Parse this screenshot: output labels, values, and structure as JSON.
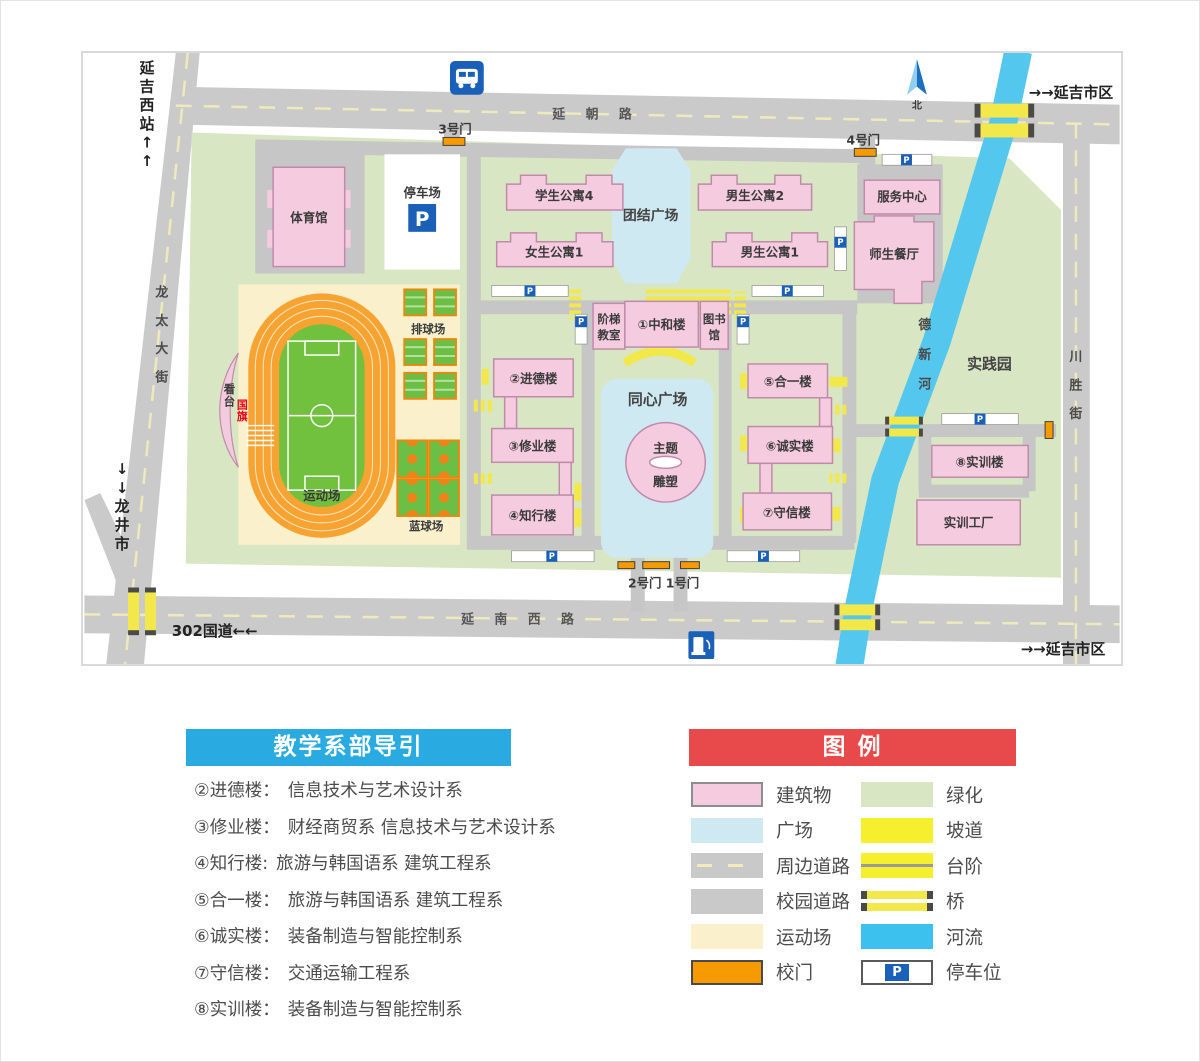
{
  "map": {
    "p": "P",
    "labels": {
      "station": "延吉西站↑↑",
      "city_top": "→→延吉市区",
      "city_bottom": "→→延吉市区",
      "longjing": "↓↓龙井市",
      "national_road": "302国道←←",
      "north": "北",
      "road_yanchao": "延 朝 路",
      "road_yannanxi": "延 南 西 路",
      "road_longtai": "龙太大街",
      "road_chuansheng": "川胜街",
      "river_dexin": "德新河",
      "gate3": "3号门",
      "gate4": "4号门",
      "gate21": "2号门 1号门",
      "parking_lot": "停车场"
    },
    "buildings": {
      "tiyuguan": "体育馆",
      "xuesheng4": "学生公寓4",
      "nansheng2": "男生公寓2",
      "nvsheng1": "女生公寓1",
      "nansheng1": "男生公寓1",
      "fuwu": "服务中心",
      "shisheng": "师生餐厅",
      "jieti1": "阶梯",
      "jieti2": "教室",
      "zhonghe": "①中和楼",
      "tushu1": "图书",
      "tushu2": "馆",
      "jinde": "②进德楼",
      "xiuye": "③修业楼",
      "zhixing": "④知行楼",
      "heyi": "⑤合一楼",
      "chengshi": "⑥诚实楼",
      "shouxin": "⑦守信楼",
      "shixunlou": "⑧实训楼",
      "shixun_gongchang": "实训工厂"
    },
    "areas": {
      "tuanjie": "团结广场",
      "tongxin": "同心广场",
      "shijianyuan": "实践园",
      "paiqiuchang": "排球场",
      "lanqiuchang": "蓝球场",
      "yundongchang": "运动场",
      "kantai": "看台",
      "guoqi": "国旗",
      "zhuti": "主题",
      "diaosu": "雕塑"
    }
  },
  "guide": {
    "title": "教学系部导引",
    "items": [
      {
        "name": "②进德楼：",
        "dept": "信息技术与艺术设计系"
      },
      {
        "name": "③修业楼：",
        "dept": "财经商贸系  信息技术与艺术设计系"
      },
      {
        "name": "④知行楼:",
        "dept": "旅游与韩国语系  建筑工程系"
      },
      {
        "name": "⑤合一楼：",
        "dept": "旅游与韩国语系  建筑工程系"
      },
      {
        "name": "⑥诚实楼：",
        "dept": "装备制造与智能控制系"
      },
      {
        "name": "⑦守信楼：",
        "dept": "交通运输工程系"
      },
      {
        "name": "⑧实训楼：",
        "dept": "装备制造与智能控制系"
      }
    ]
  },
  "legend": {
    "title": "图  例",
    "col1": [
      {
        "label": "建筑物"
      },
      {
        "label": "广场"
      },
      {
        "label": "周边道路"
      },
      {
        "label": "校园道路"
      },
      {
        "label": "运动场"
      },
      {
        "label": "校门"
      }
    ],
    "col2": [
      {
        "label": "绿化"
      },
      {
        "label": "坡道"
      },
      {
        "label": "台阶"
      },
      {
        "label": "桥"
      },
      {
        "label": "河流"
      },
      {
        "label": "停车位"
      }
    ]
  },
  "colors": {
    "building": "#f5cbdf",
    "plaza": "#cfe9f2",
    "green": "#d9e6c3",
    "road": "#cacaca",
    "field": "#faf0cc",
    "gate": "#f59a00",
    "river": "#54c7ef",
    "ramp": "#f2e84a",
    "accent_blue": "#29abe2",
    "accent_red": "#e8494a",
    "parking_blue": "#1a5fb8"
  }
}
